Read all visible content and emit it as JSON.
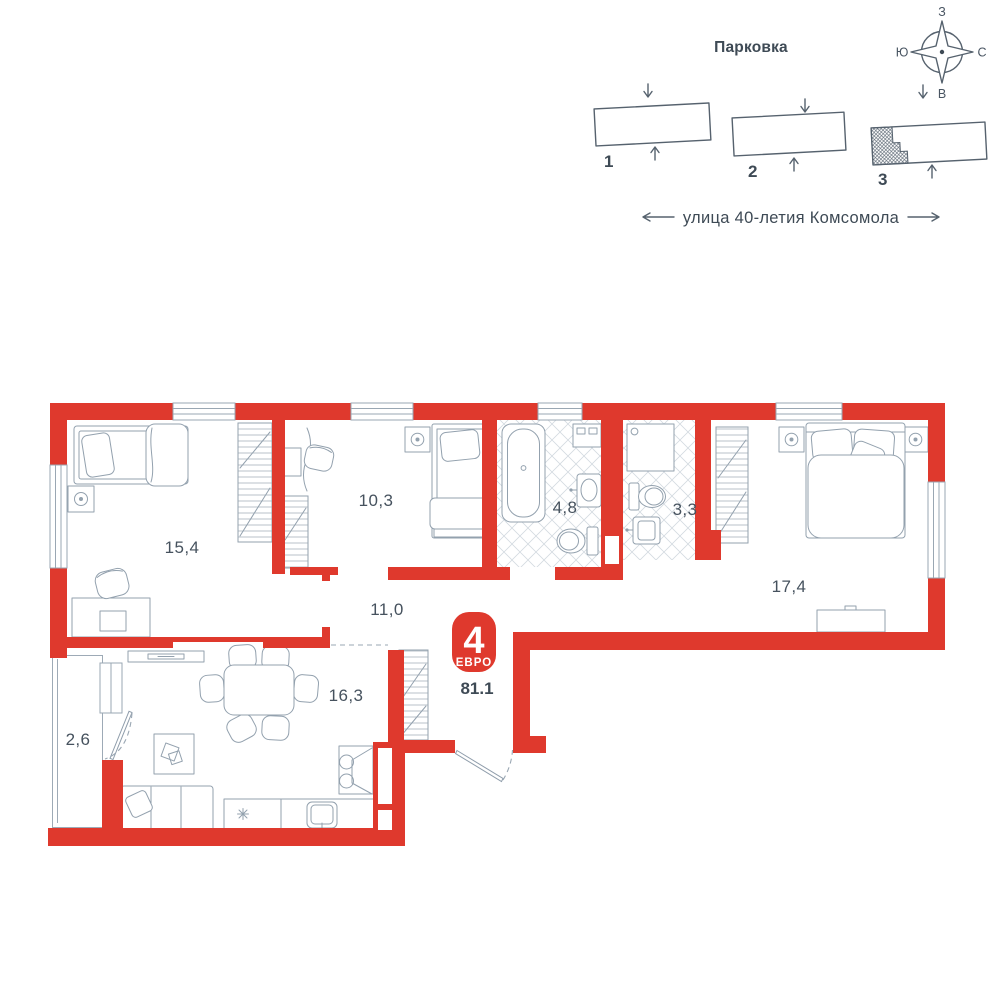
{
  "site_plan": {
    "parking_label": "Парковка",
    "street_label": "улица 40-летия Комсомола",
    "compass": {
      "top": "З",
      "left": "Ю",
      "right": "С",
      "bottom": "В"
    },
    "buildings": [
      {
        "number": "1",
        "highlighted": false
      },
      {
        "number": "2",
        "highlighted": false
      },
      {
        "number": "3",
        "highlighted": true
      }
    ]
  },
  "apartment": {
    "rooms_count": "4",
    "layout_type": "ЕВРО",
    "total_area": "81.1",
    "rooms": [
      {
        "name": "bedroom-1",
        "area": "15,4"
      },
      {
        "name": "bedroom-2",
        "area": "10,3"
      },
      {
        "name": "bathroom",
        "area": "4,8"
      },
      {
        "name": "wc",
        "area": "3,3"
      },
      {
        "name": "bedroom-3",
        "area": "17,4"
      },
      {
        "name": "hallway",
        "area": "11,0"
      },
      {
        "name": "kitchen-living",
        "area": "16,3"
      },
      {
        "name": "balcony",
        "area": "2,6"
      }
    ]
  },
  "colors": {
    "wall": "#df392d",
    "text": "#3e4a55",
    "furniture": "#93a1ae"
  }
}
